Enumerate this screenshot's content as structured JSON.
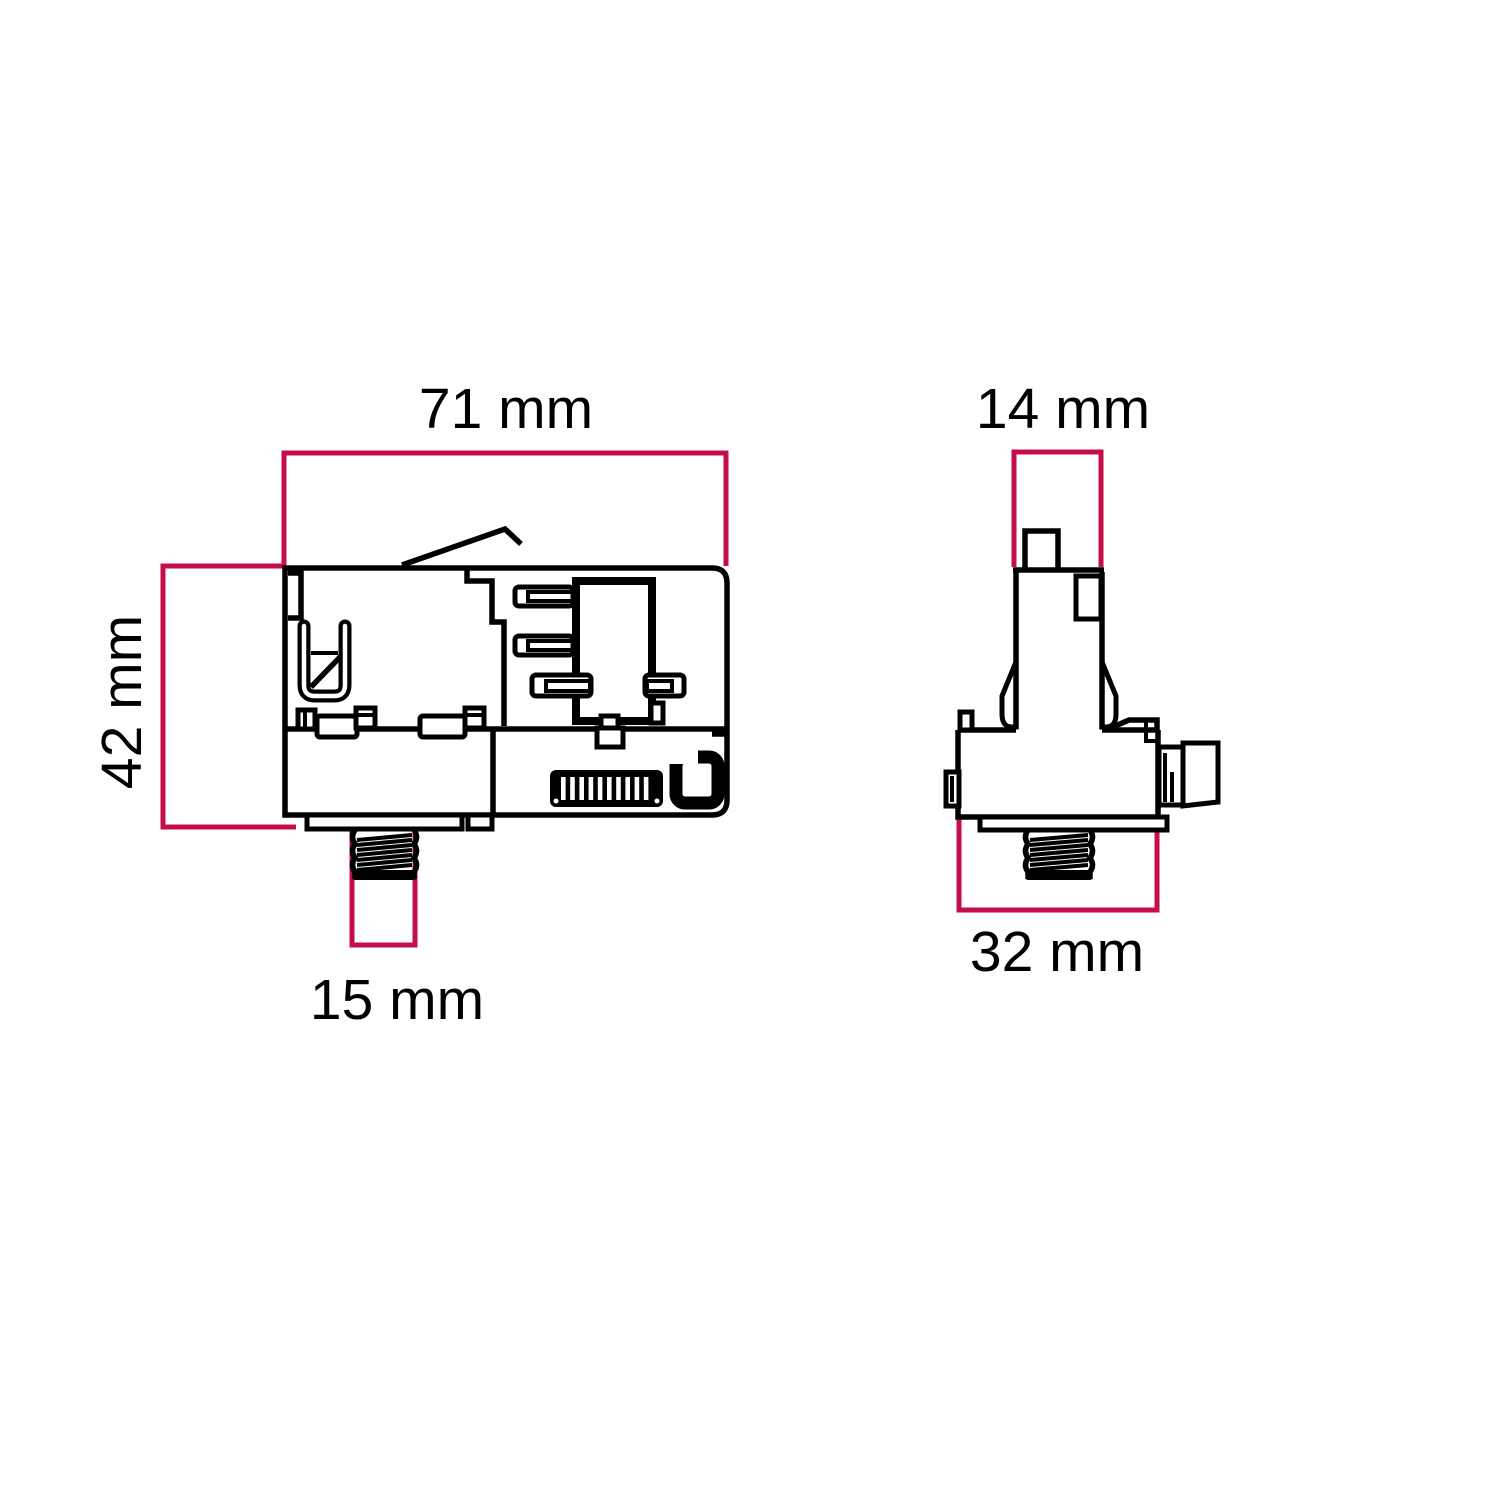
{
  "page": {
    "background": "#ffffff"
  },
  "drawing": {
    "line_color": "#000000",
    "dimension_color": "#c50d4a",
    "views": {
      "side": {
        "width_label": "71 mm",
        "height_label": "42 mm",
        "stud_width_label": "15 mm"
      },
      "front": {
        "stem_width_label": "14 mm",
        "base_width_label": "32 mm"
      }
    }
  }
}
